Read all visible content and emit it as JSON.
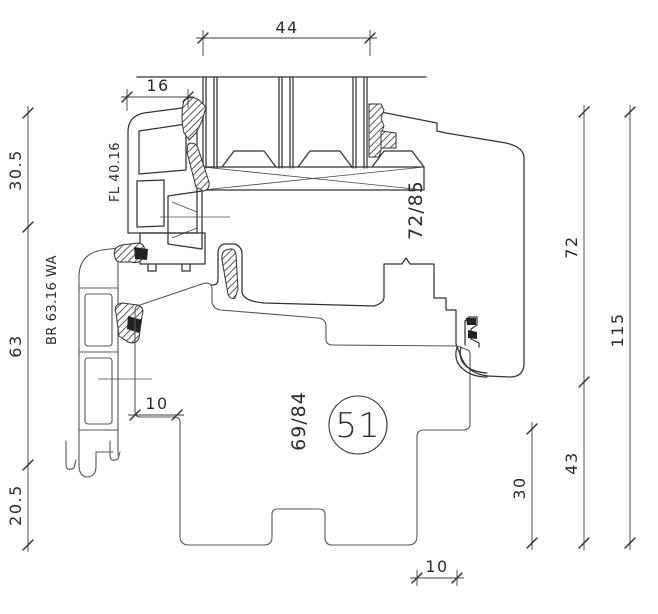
{
  "drawing": {
    "detail_marker": "51",
    "profiles": {
      "glazing_bead": "FL 40.16",
      "extension": "BR 63.16 WA",
      "sash": "72/85",
      "frame": "69/84"
    },
    "dimensions": {
      "glass_width": "44",
      "bead_width": "16",
      "left": [
        "30.5",
        "63",
        "20.5"
      ],
      "sash_height": "72",
      "total_height": "115",
      "frame_height": "43",
      "step_height": "30",
      "frame_step": "10",
      "bottom_step": "10"
    },
    "colors": {
      "line_dark": "#333333",
      "line_gray": "#565656",
      "background": "#ffffff"
    }
  }
}
